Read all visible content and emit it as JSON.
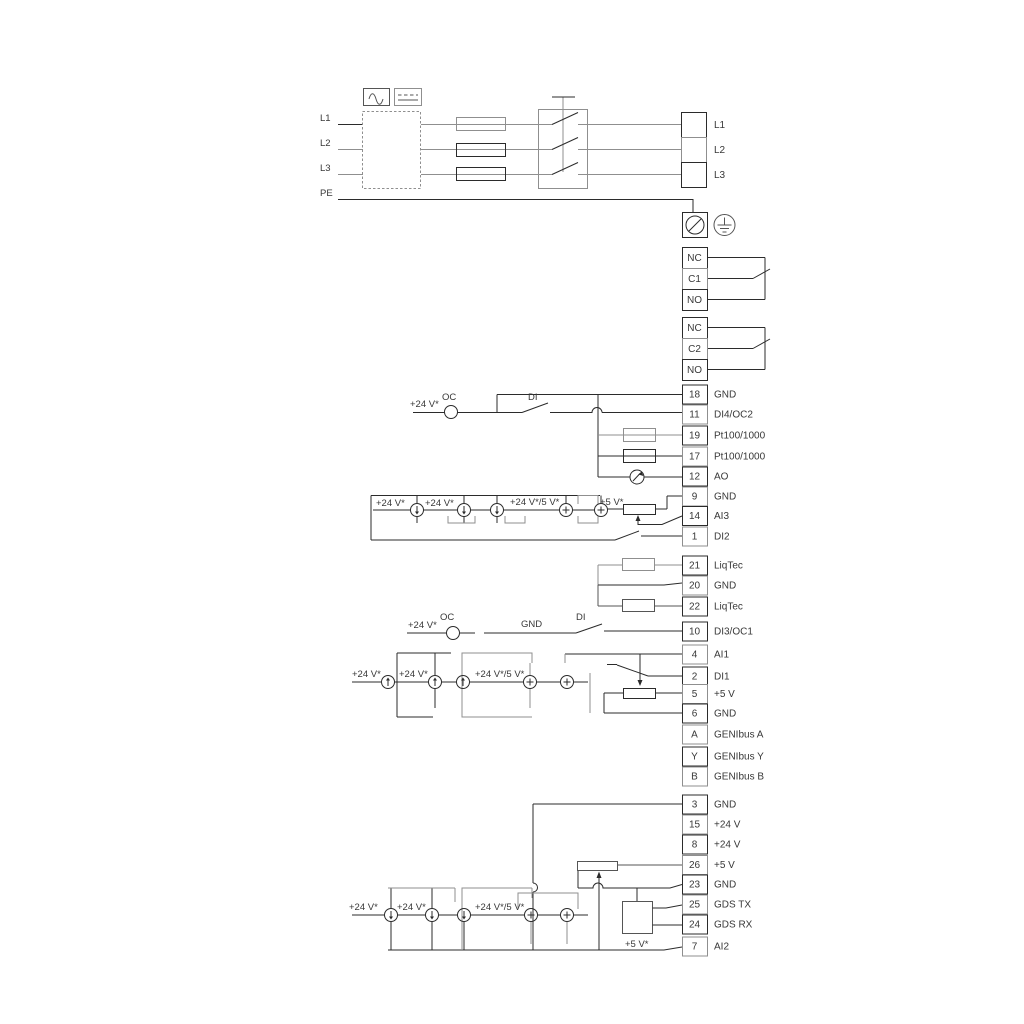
{
  "diagram": {
    "kind": "electrical-wiring-diagram",
    "colors": {
      "line_black": "#2b2b2b",
      "line_gray": "#8f8f8f",
      "text": "#383838",
      "background": "#ffffff"
    },
    "symbols": {
      "filter_box": "dashed-rectangle-filter",
      "ac_symbol": "sine-wave-icon",
      "dc_symbol": "dashed-line-icon",
      "fuse": "fuse-rectangle",
      "main_switch": "three-pole-disconnect-switch",
      "pe_terminal": "circle-slash-terminal",
      "earth": "protective-earth-icon",
      "current_source": "circle-arrow-source",
      "voltage_source": "circle-plus-source",
      "analog_output_meter": "gauge-needle-icon",
      "potentiometer": "pot-with-wiper-arrow",
      "resistor": "rectangle-resistor",
      "digital_input_switch": "switch-contact"
    },
    "power_input": {
      "labels": [
        "L1",
        "L2",
        "L3",
        "PE"
      ]
    },
    "power_output": {
      "labels": [
        "L1",
        "L2",
        "L3"
      ]
    },
    "relays": [
      {
        "terminals": [
          "NC",
          "C1",
          "NO"
        ]
      },
      {
        "terminals": [
          "NC",
          "C2",
          "NO"
        ]
      }
    ],
    "terminal_groups": [
      {
        "id": "io-top",
        "terminals": [
          {
            "n": "18",
            "label": "GND"
          },
          {
            "n": "11",
            "label": "DI4/OC2"
          },
          {
            "n": "19",
            "label": "Pt100/1000"
          },
          {
            "n": "17",
            "label": "Pt100/1000"
          },
          {
            "n": "12",
            "label": "AO"
          },
          {
            "n": "9",
            "label": "GND"
          },
          {
            "n": "14",
            "label": "AI3"
          },
          {
            "n": "1",
            "label": "DI2"
          }
        ]
      },
      {
        "id": "liqtec",
        "terminals": [
          {
            "n": "21",
            "label": "LiqTec"
          },
          {
            "n": "20",
            "label": "GND"
          },
          {
            "n": "22",
            "label": "LiqTec"
          }
        ]
      },
      {
        "id": "io-mid",
        "terminals": [
          {
            "n": "10",
            "label": "DI3/OC1"
          },
          {
            "n": "4",
            "label": "AI1"
          },
          {
            "n": "2",
            "label": "DI1"
          },
          {
            "n": "5",
            "label": "+5 V"
          },
          {
            "n": "6",
            "label": "GND"
          },
          {
            "n": "A",
            "label": "GENIbus A"
          },
          {
            "n": "Y",
            "label": "GENIbus Y"
          },
          {
            "n": "B",
            "label": "GENIbus B"
          }
        ]
      },
      {
        "id": "io-bottom",
        "terminals": [
          {
            "n": "3",
            "label": "GND"
          },
          {
            "n": "15",
            "label": "+24 V"
          },
          {
            "n": "8",
            "label": "+24 V"
          },
          {
            "n": "26",
            "label": "+5 V"
          },
          {
            "n": "23",
            "label": "GND"
          },
          {
            "n": "25",
            "label": "GDS TX"
          },
          {
            "n": "24",
            "label": "GDS RX"
          },
          {
            "n": "7",
            "label": "AI2"
          }
        ]
      }
    ],
    "annotations": {
      "oc2_supply": "+24 V*",
      "oc2": "OC",
      "di4": "DI",
      "ai3_s1": "+24 V*",
      "ai3_s2": "+24 V*",
      "ai3_s3": "+24 V*/5 V*",
      "ai3_s4": "+5 V*",
      "oc1_supply": "+24 V*",
      "oc1": "OC",
      "gnd_wire": "GND",
      "di3": "DI",
      "ai1_s1": "+24 V*",
      "ai1_s2": "+24 V*",
      "ai1_s3": "+24 V*/5 V*",
      "ai2_s1": "+24 V*",
      "ai2_s2": "+24 V*",
      "ai2_s3": "+24 V*/5 V*",
      "ai2_s4": "+5 V*"
    }
  }
}
